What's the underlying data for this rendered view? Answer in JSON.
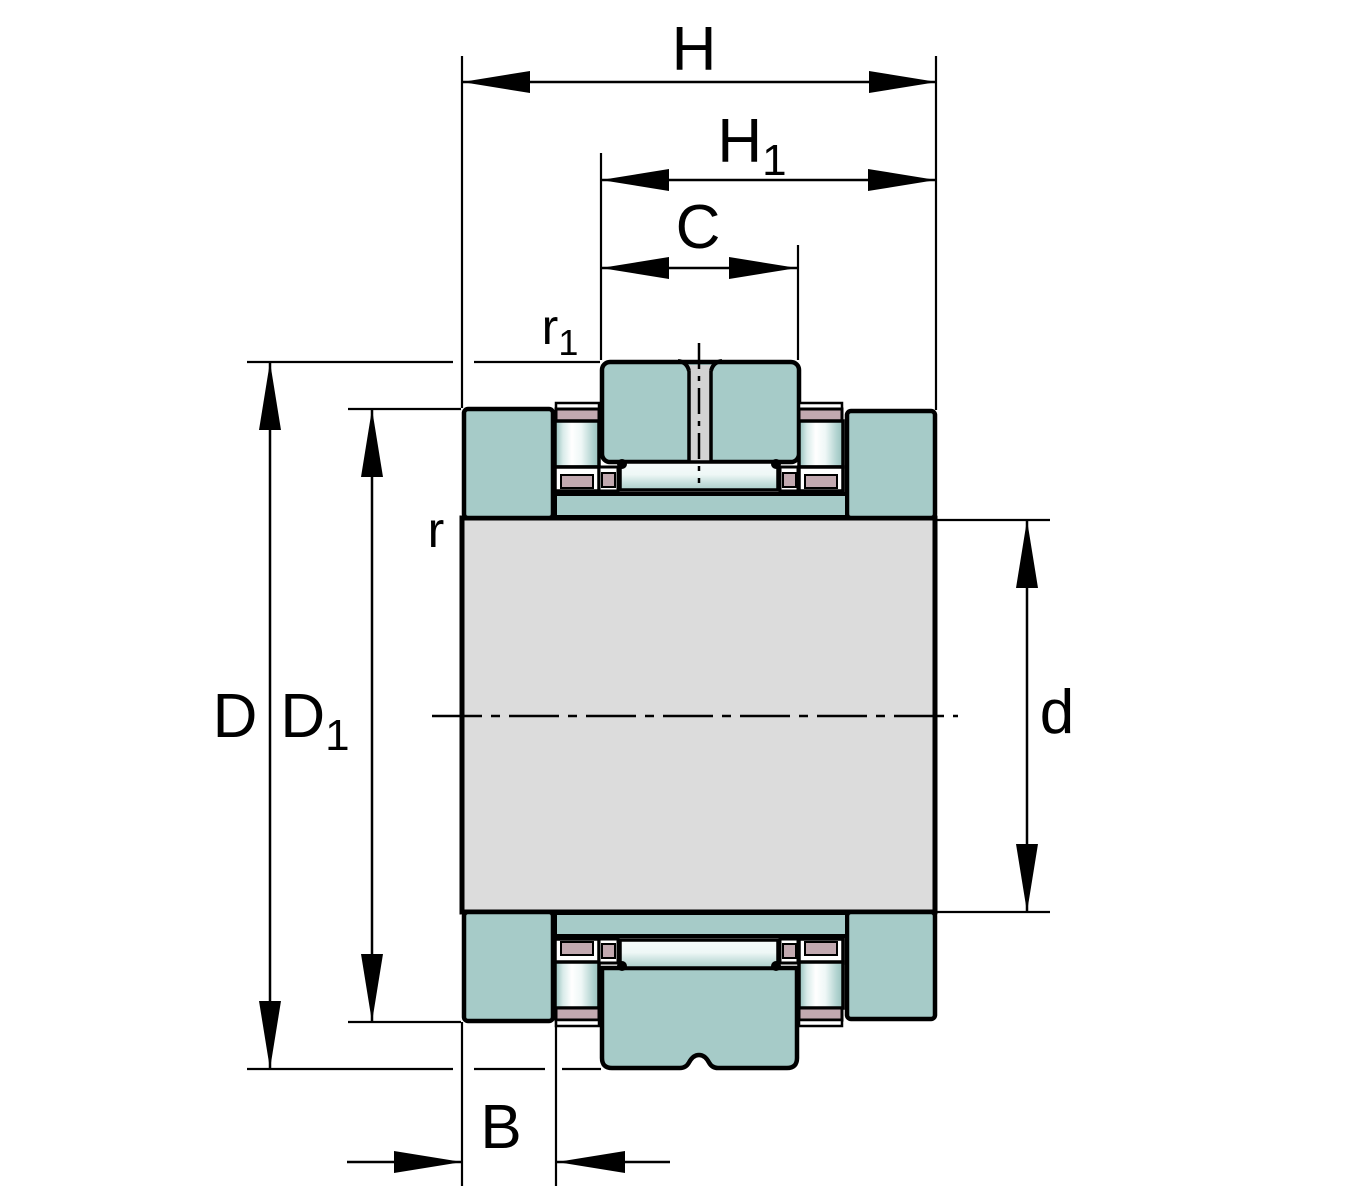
{
  "drawing": {
    "description": "Technical cross-section drawing of a needle roller / axial cylindrical roller bearing with dimension annotations",
    "labels": {
      "H": {
        "base": "H",
        "sub": ""
      },
      "H1": {
        "base": "H",
        "sub": "1"
      },
      "C": {
        "base": "C",
        "sub": ""
      },
      "r1": {
        "base": "r",
        "sub": "1"
      },
      "r": {
        "base": "r",
        "sub": ""
      },
      "D": {
        "base": "D",
        "sub": ""
      },
      "D1": {
        "base": "D",
        "sub": "1"
      },
      "d": {
        "base": "d",
        "sub": ""
      },
      "B": {
        "base": "B",
        "sub": ""
      }
    },
    "colors": {
      "bearing_teal": "#a6cbc8",
      "cage_pink": "#c2a9b0",
      "shaft_gray": "#dcdcdc",
      "bore_hole_gray": "#d3d3d3",
      "outline_black": "#000000",
      "background": "#ffffff"
    }
  }
}
